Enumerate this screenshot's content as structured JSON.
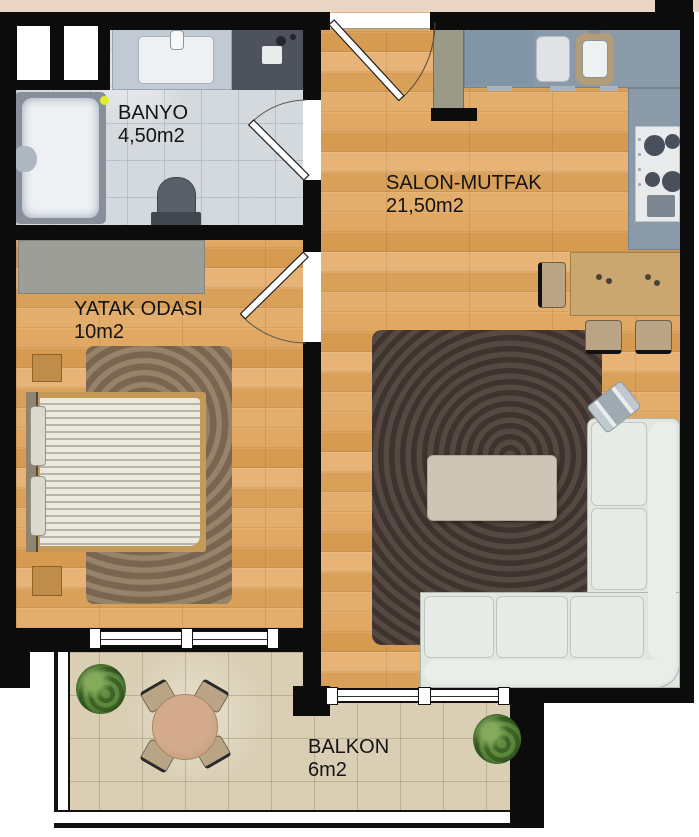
{
  "title": "Apartment floor plan",
  "rooms": [
    {
      "name": "BANYO",
      "area": "4,50m2"
    },
    {
      "name": "SALON-MUTFAK",
      "area": "21,50m2"
    },
    {
      "name": "YATAK ODASI",
      "area": "10m2"
    },
    {
      "name": "BALKON",
      "area": "6m2"
    }
  ],
  "colors": {
    "wall": "#0c0c0c",
    "wood_floor": "#dda55e",
    "bathroom_tile": "#d4d9dd",
    "balcony_tile": "#dacfb5",
    "kitchen_counter": "#8a9aa8",
    "living_rug": "#493d38",
    "bedroom_rug": "#8b7660",
    "sofa": "#e1e6e1",
    "dining_table": "#c9a76e",
    "label_text": "#141414",
    "exterior_strip": "#e9d6c6",
    "plant_green": "#4e7a33",
    "bathtub_indicator": "#e3ee27"
  }
}
